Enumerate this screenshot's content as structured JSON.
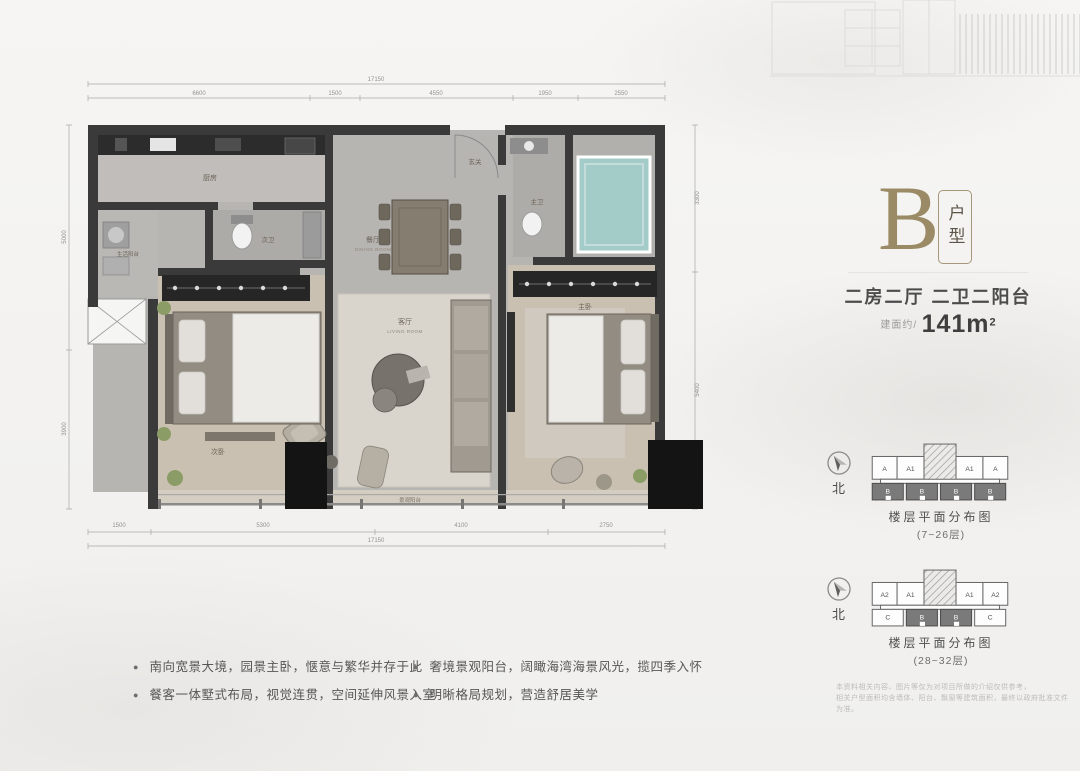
{
  "header": {
    "type_letter": "B",
    "type_label": "户型"
  },
  "summary": {
    "layout": "二房二厅 二卫二阳台",
    "area_prefix": "建面约/",
    "area_value": "141m",
    "area_sup": "2"
  },
  "north_label": "北",
  "diagrams": [
    {
      "caption": "楼层平面分布图",
      "floors": "(7~26层)",
      "top_cells": [
        "A",
        "A1",
        "A1",
        "A"
      ],
      "bottom_cells": [
        "B",
        "B",
        "B",
        "B"
      ]
    },
    {
      "caption": "楼层平面分布图",
      "floors": "(28~32层)",
      "top_cells": [
        "A2",
        "A1",
        "A1",
        "A2"
      ],
      "bottom_cells": [
        "C",
        "B",
        "B",
        "C"
      ]
    }
  ],
  "disclaimer": {
    "line1": "本资料相关内容、图片等仅为对项目所做的介绍仅供参考，",
    "line2": "相关户型面积均含墙体、阳台、飘窗等建筑面积，最终以政府批准文件为准。"
  },
  "bullets": [
    "南向宽景大境，园景主卧，惬意与繁华并存于此",
    "餐客一体墅式布局，视觉连贯，空间延伸风景入室",
    "奢境景观阳台，阔瞰海湾海景风光，揽四季入怀",
    "明晰格局规划，营造舒居美学"
  ],
  "floorplan": {
    "rooms": {
      "kitchen": "厨房",
      "service_balcony": "生活阳台",
      "bath2": "次卫",
      "dining_cn": "餐厅",
      "dining_en": "DINING ROOM",
      "living_cn": "客厅",
      "living_en": "LIVING ROOM",
      "entry": "玄关",
      "bath1": "主卫",
      "master": "主卧",
      "bedroom2": "次卧",
      "balcony": "景观阳台"
    },
    "dims": {
      "top_total": "17150",
      "top_seg_1": "6600",
      "top_seg_2": "1500",
      "top_seg_3": "4550",
      "top_seg_4": "1950",
      "top_seg_5": "2550",
      "bottom_seg_1": "1500",
      "bottom_seg_2": "5300",
      "bottom_seg_3": "4100",
      "bottom_seg_4": "2750",
      "bottom_total": "17150",
      "left_seg_1": "5000",
      "left_seg_2": "3900",
      "right_seg_1": "3300",
      "right_seg_2": "5400"
    }
  },
  "colors": {
    "accent_bronze": "#9b8a66",
    "wall": "#3a3a3a",
    "tub": "#a3cbc7"
  }
}
